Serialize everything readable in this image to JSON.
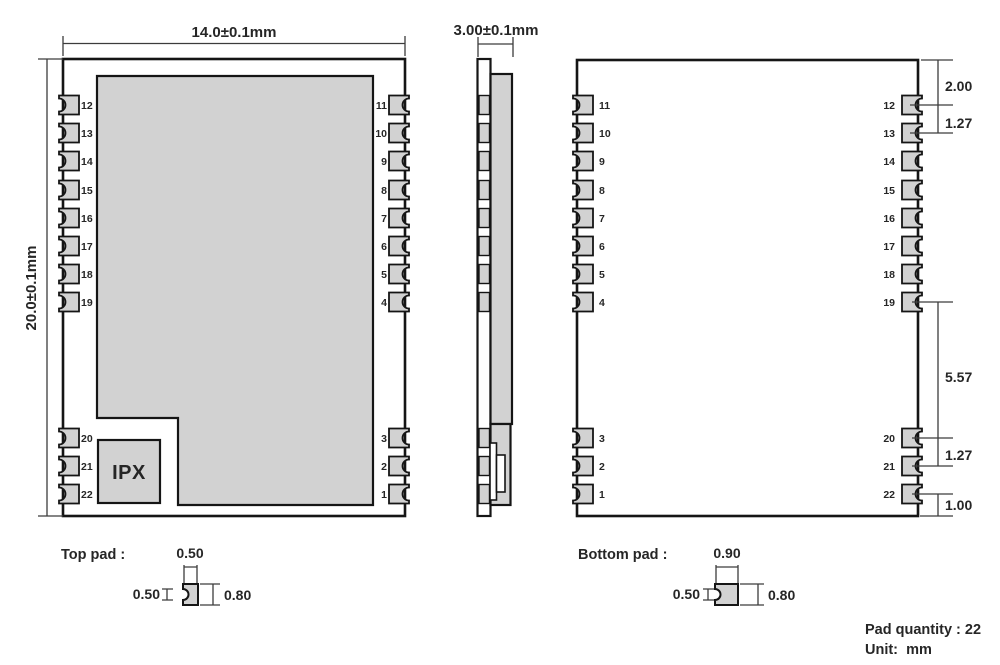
{
  "colors": {
    "pad_fill": "#d2d2d2",
    "outline": "#151515",
    "dim_line": "#3c3c3c",
    "text": "#262626",
    "background": "#ffffff"
  },
  "top_view": {
    "width_label": "14.0±0.1mm",
    "height_label": "20.0±0.1mm",
    "ipx_label": "IPX",
    "left_pins_top": [
      "12",
      "13",
      "14",
      "15",
      "16",
      "17",
      "18",
      "19"
    ],
    "left_pins_bottom": [
      "20",
      "21",
      "22"
    ],
    "right_pins_top": [
      "11",
      "10",
      "9",
      "8",
      "7",
      "6",
      "5",
      "4"
    ],
    "right_pins_bottom": [
      "3",
      "2",
      "1"
    ]
  },
  "side_view": {
    "thickness_label": "3.00±0.1mm"
  },
  "bottom_view": {
    "left_pins_top": [
      "11",
      "10",
      "9",
      "8",
      "7",
      "6",
      "5",
      "4"
    ],
    "left_pins_bottom": [
      "3",
      "2",
      "1"
    ],
    "right_pins_top": [
      "12",
      "13",
      "14",
      "15",
      "16",
      "17",
      "18",
      "19"
    ],
    "right_pins_bottom": [
      "20",
      "21",
      "22"
    ],
    "dims": {
      "top_margin": "2.00",
      "pitch_top": "1.27",
      "mid_gap": "5.57",
      "pitch_bottom": "1.27",
      "bottom_margin": "1.00"
    }
  },
  "pad_details": {
    "top": {
      "label": "Top pad :",
      "width": "0.50",
      "notch": "0.50",
      "height": "0.80"
    },
    "bottom": {
      "label": "Bottom pad :",
      "width": "0.90",
      "notch": "0.50",
      "height": "0.80"
    }
  },
  "notes": {
    "pad_quantity": "Pad quantity : 22",
    "unit": "Unit:  mm"
  }
}
